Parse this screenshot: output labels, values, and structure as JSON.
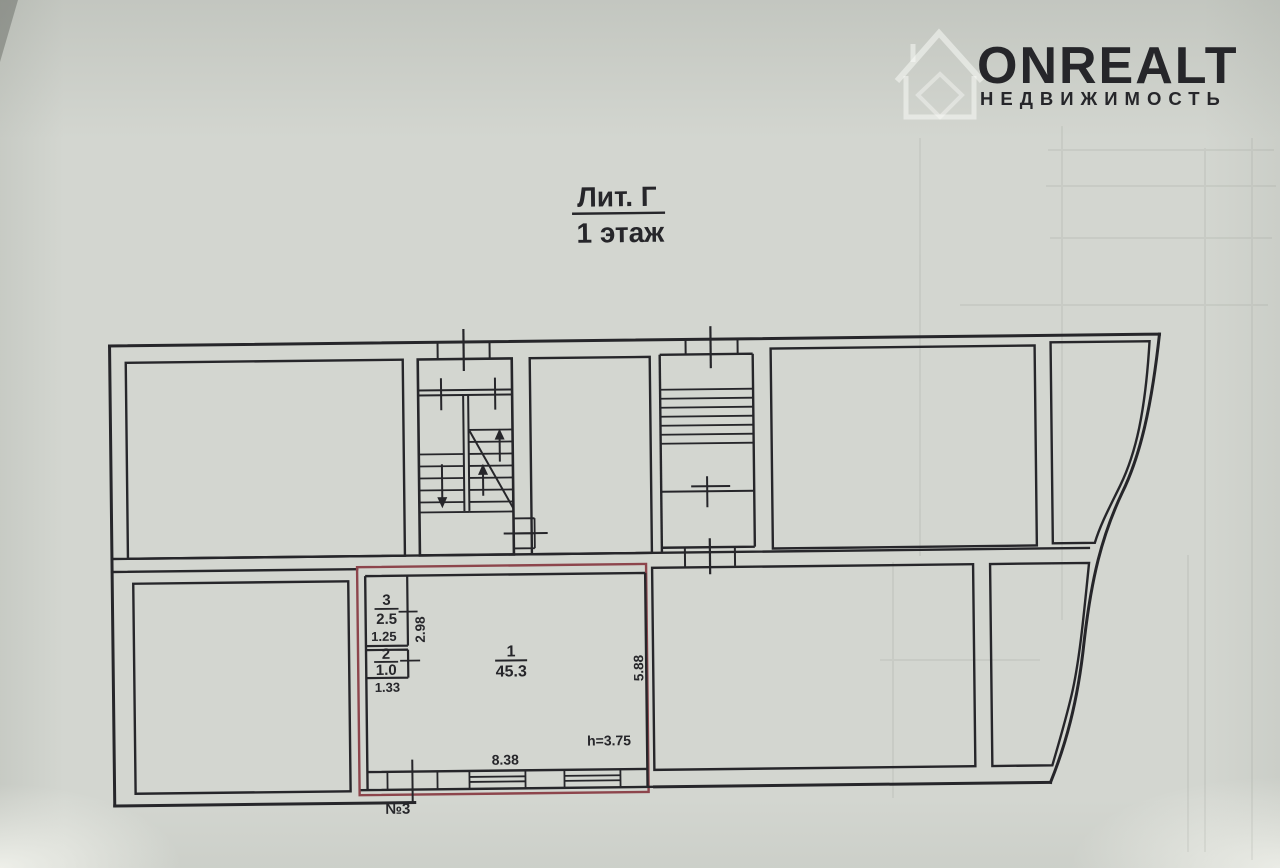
{
  "watermark": {
    "brand": "ONREALT",
    "subtitle": "НЕДВИЖИМОСТЬ",
    "icon": "house-icon"
  },
  "title": {
    "line1": "Лит. Г",
    "line2": "1 этаж"
  },
  "plan": {
    "unit": {
      "label": "№3",
      "rooms": [
        {
          "number": "1",
          "area": "45.3"
        },
        {
          "number": "2",
          "area": "1.0"
        },
        {
          "number": "3",
          "area": "2.5"
        }
      ],
      "dimensions": {
        "bottom_width": "8.38",
        "right_height": "5.88",
        "room3_width": "1.25",
        "room3_depth": "2.98",
        "room2_width": "1.33",
        "ceiling_height": "h=3.75"
      }
    },
    "colors": {
      "line": "#26262a",
      "highlight": "#8d454c",
      "paper": "#d3d6d0"
    }
  }
}
